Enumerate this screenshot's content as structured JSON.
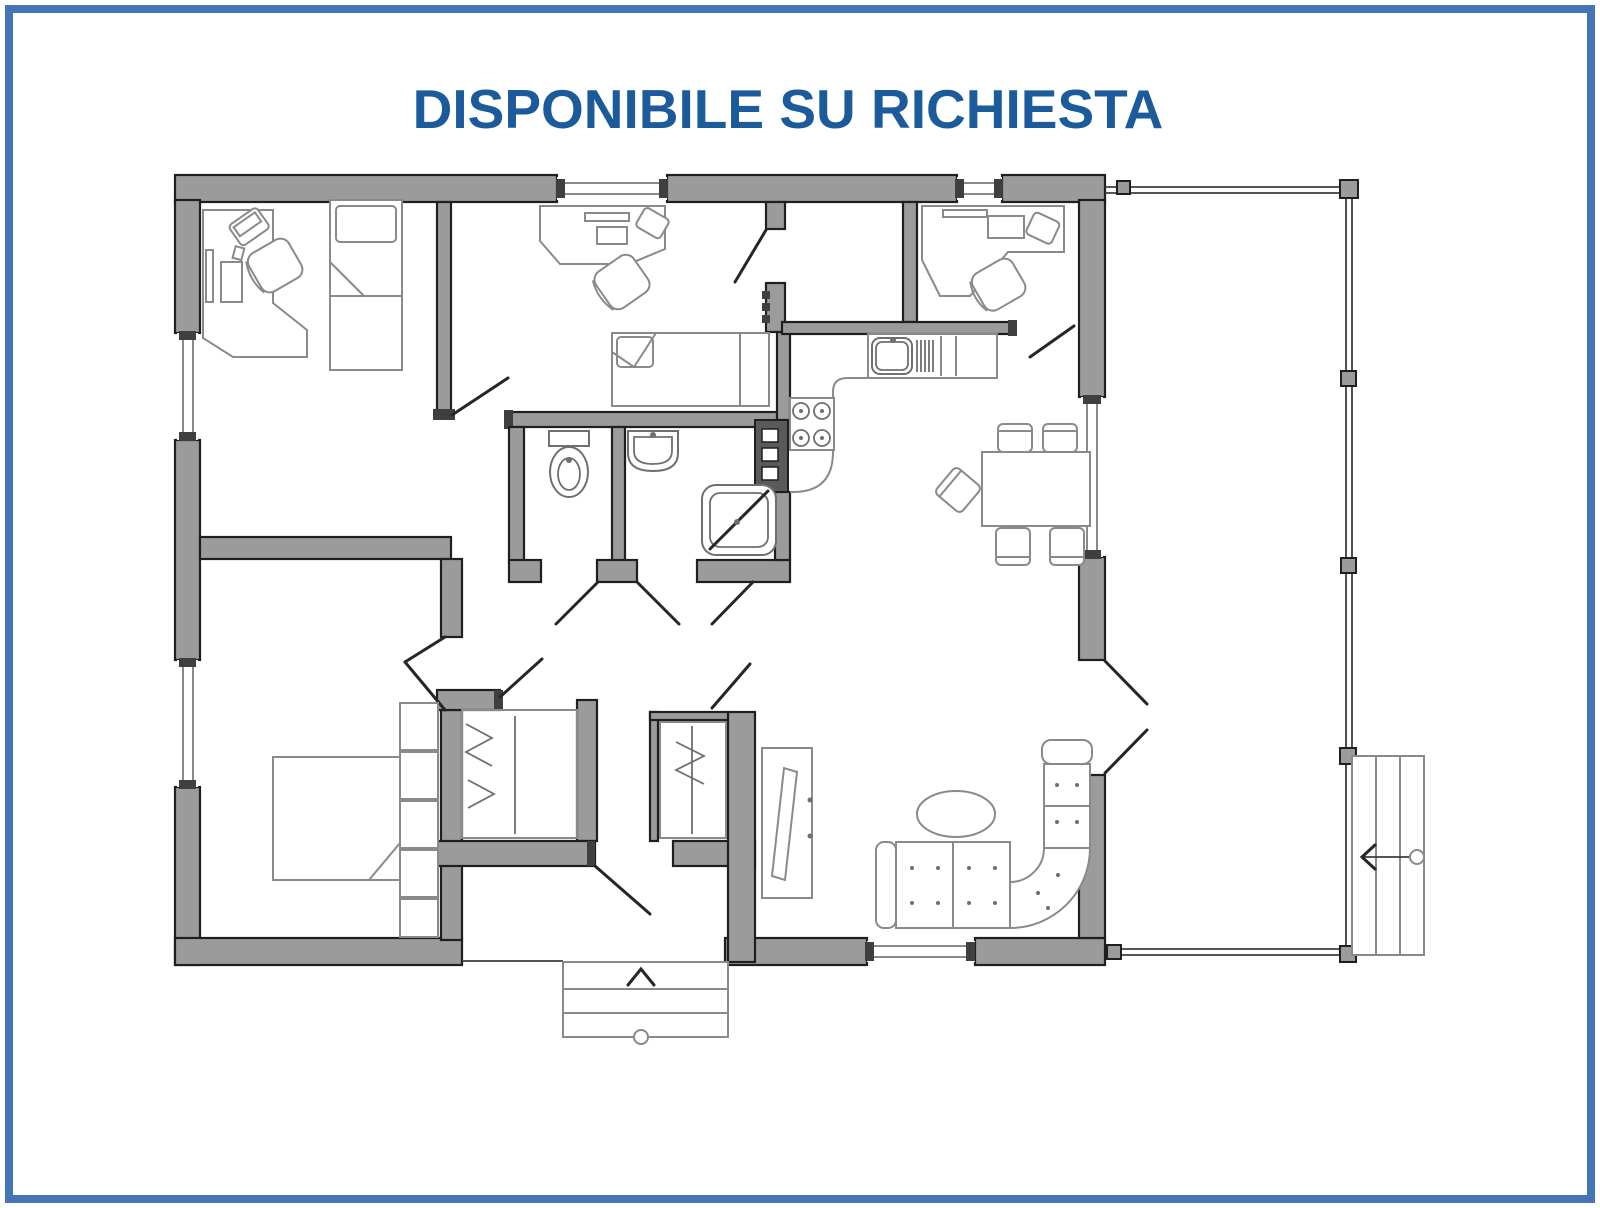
{
  "title": {
    "text": "DISPONIBILE SU RICHIESTA"
  },
  "colors": {
    "page-bg": "#ffffff",
    "border-blue": "#4575b4",
    "title-blue": "#1b5a9b",
    "wall-fill": "#9b9b9b",
    "wall-line": "#1f1f1f",
    "jamb-dark": "#3f3f3f",
    "furniture-line": "#8a8a8a",
    "fixture-line": "#6f6f6f",
    "door-line": "#262626",
    "railing-line": "#3c3c3c",
    "appliance-dark": "#5a5a5a"
  }
}
